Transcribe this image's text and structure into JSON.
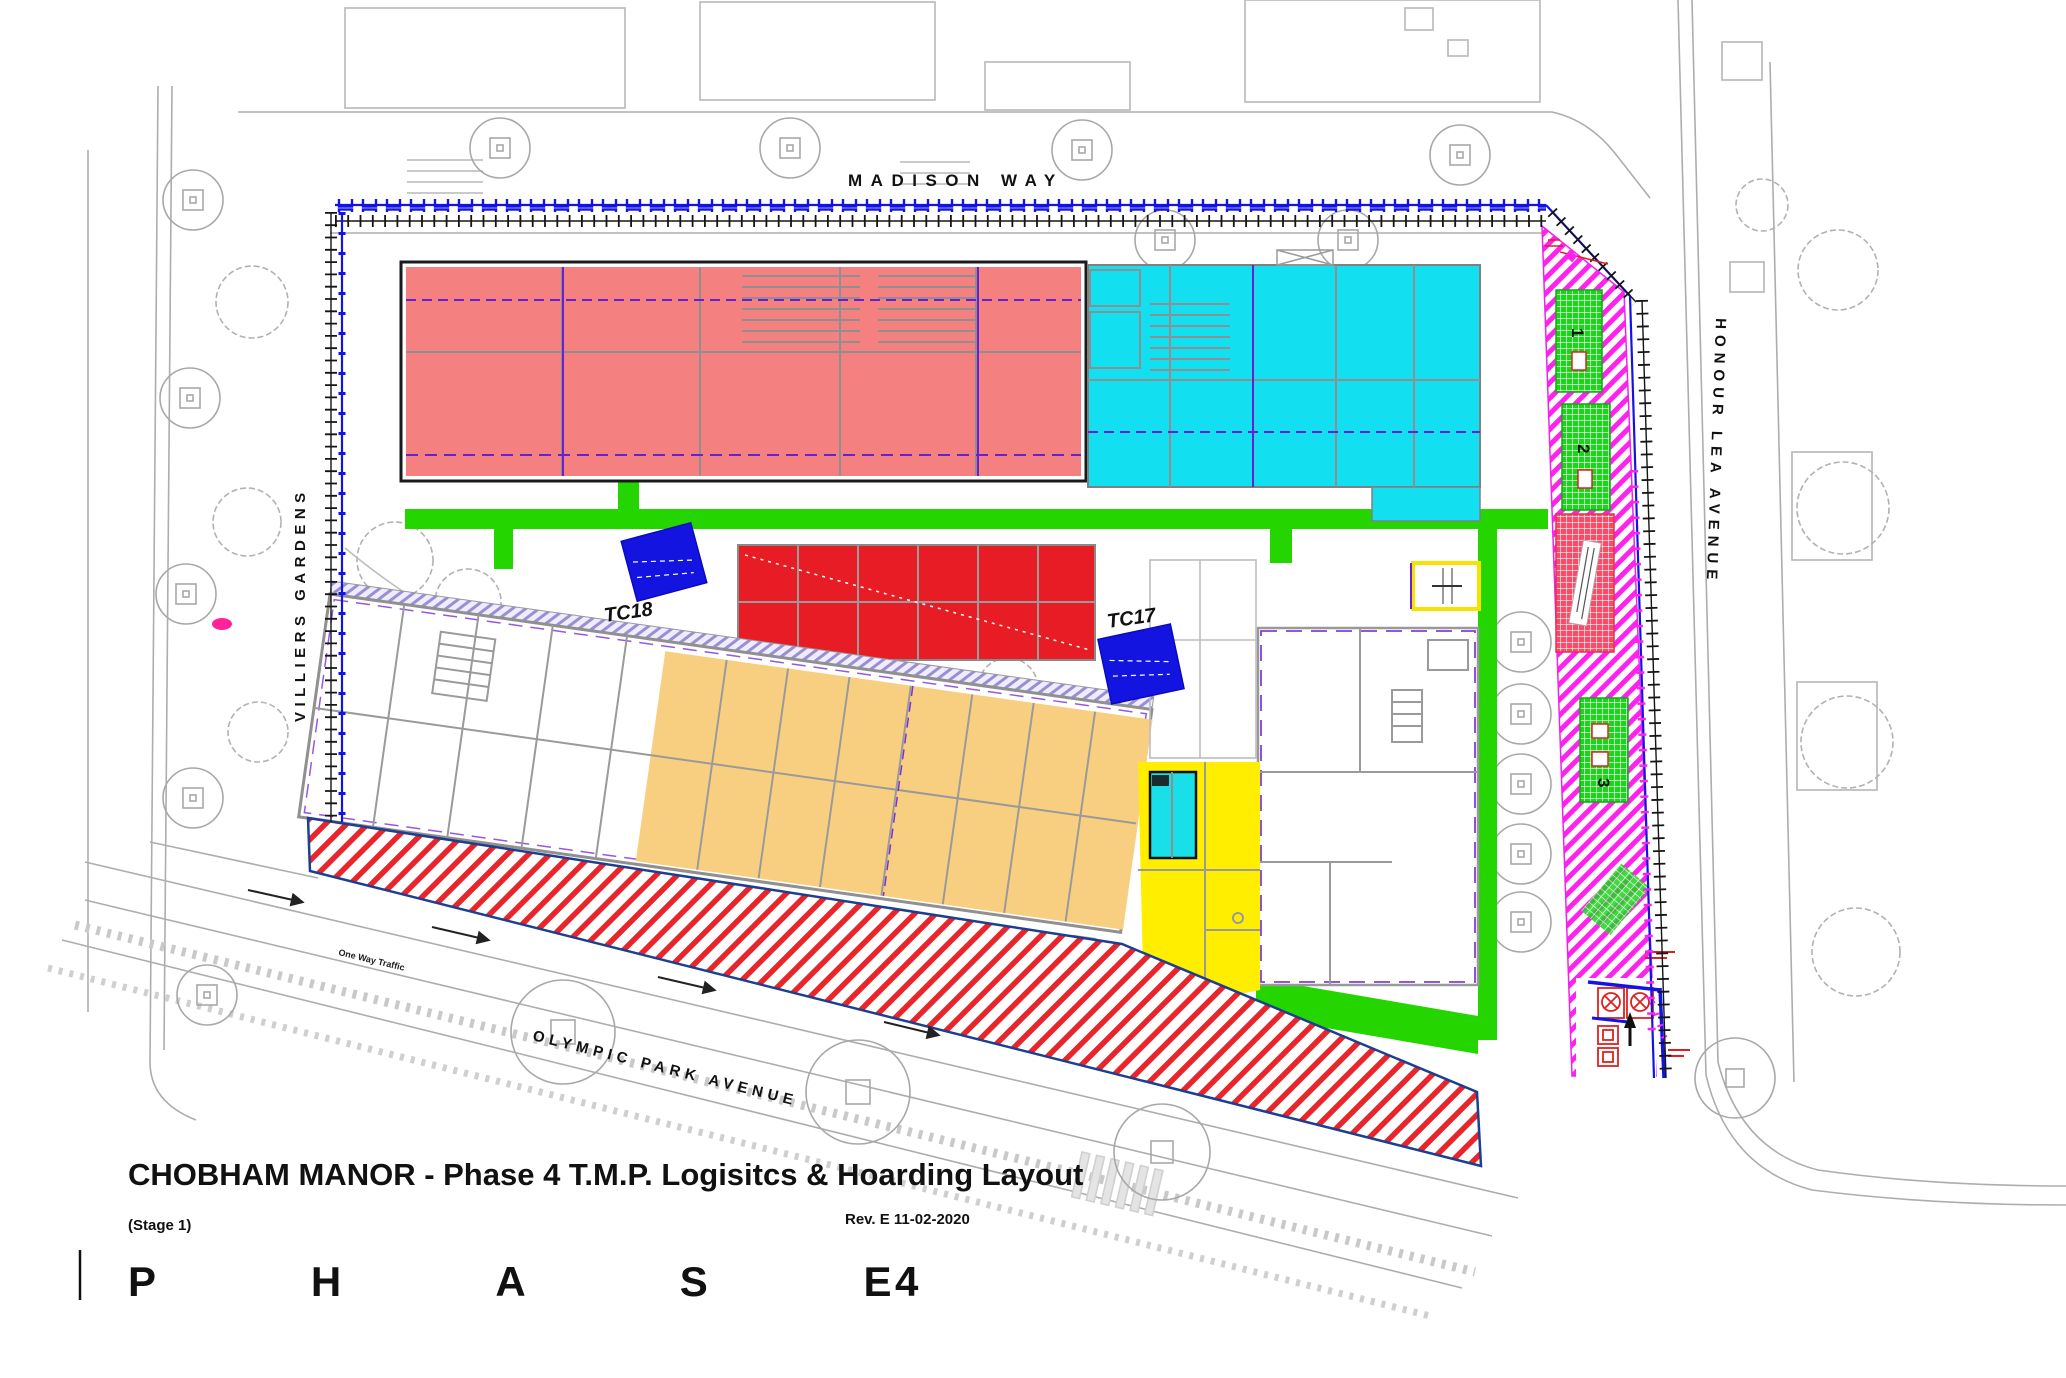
{
  "title_block": {
    "title": "CHOBHAM MANOR - Phase 4 T.M.P. Logisitcs & Hoarding Layout",
    "stage": "(Stage 1)",
    "revision": "Rev. E 11-02-2020",
    "phase_word": "P H A S E",
    "phase_number": "4"
  },
  "streets": {
    "top": "MADISON  WAY",
    "left": "VILLIERS  GARDENS",
    "right": "HONOUR  LEA  AVENUE",
    "bottom": "OLYMPIC  PARK  AVENUE",
    "traffic_note": "One Way Traffic"
  },
  "cranes": [
    {
      "id": "TC18"
    },
    {
      "id": "TC17"
    }
  ],
  "storage_blocks": [
    {
      "label": "1"
    },
    {
      "label": "2"
    },
    {
      "label": "3"
    }
  ],
  "colors": {
    "block_salmon": "#f58080",
    "block_cyan": "#12dff0",
    "block_red": "#e81c24",
    "block_orange": "#f8cf80",
    "zone_yellow": "#ffee00",
    "walkway_green": "#24d500",
    "hoarding_blue": "#1313e8",
    "laydown_magenta": "#ff22ee",
    "hatch_red": "#e8252b",
    "boundary_navy": "#1c3f8f"
  }
}
